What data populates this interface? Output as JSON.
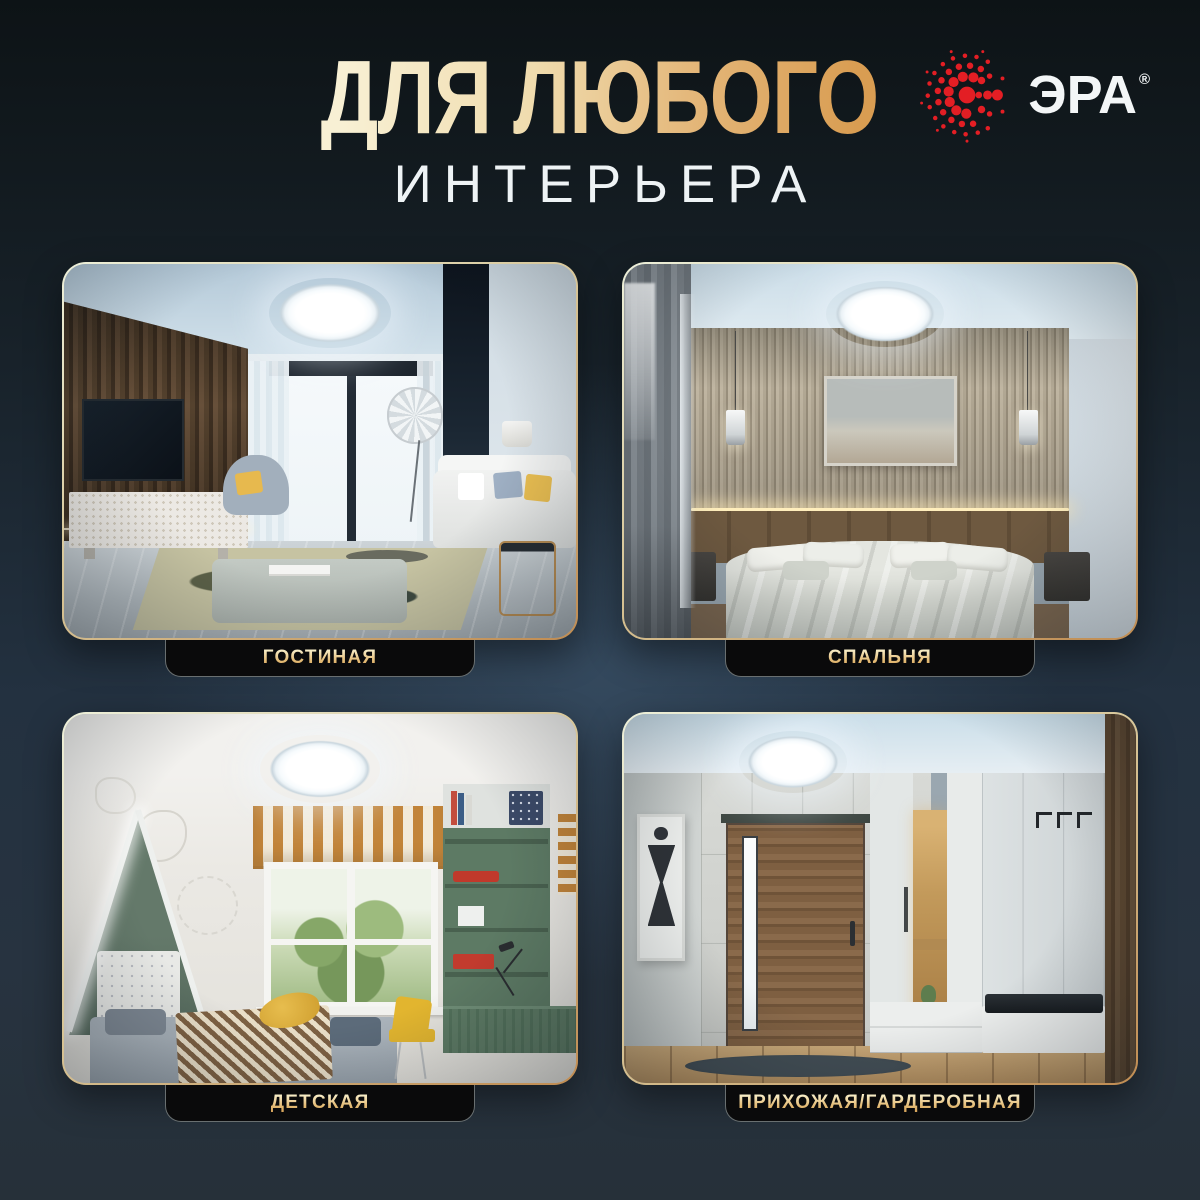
{
  "header": {
    "title_line1": "ДЛЯ ЛЮБОГО",
    "title_line2": "ИНТЕРЬЕРА",
    "brand": {
      "name": "ЭРА",
      "registered_mark": "®"
    }
  },
  "colors": {
    "background_top": "#0e1418",
    "background_center": "#2f3e4d",
    "background_bottom": "#263039",
    "title_gold_light": "#f6edcd",
    "title_gold_dark": "#d99f55",
    "subtitle_white": "#eef3f5",
    "brand_red": "#e31e24",
    "label_background": "#0a0a0b",
    "label_gold_light": "#f6e9c2",
    "label_gold_dark": "#d8a860",
    "card_border_light": "#e8ecd4",
    "card_border_gold": "#c08c52"
  },
  "rooms": [
    {
      "id": "living-room",
      "label": "ГОСТИНАЯ"
    },
    {
      "id": "bedroom",
      "label": "СПАЛЬНЯ"
    },
    {
      "id": "kids-room",
      "label": "ДЕТСКАЯ"
    },
    {
      "id": "hallway",
      "label": "ПРИХОЖАЯ/ГАРДЕРОБНАЯ"
    }
  ]
}
